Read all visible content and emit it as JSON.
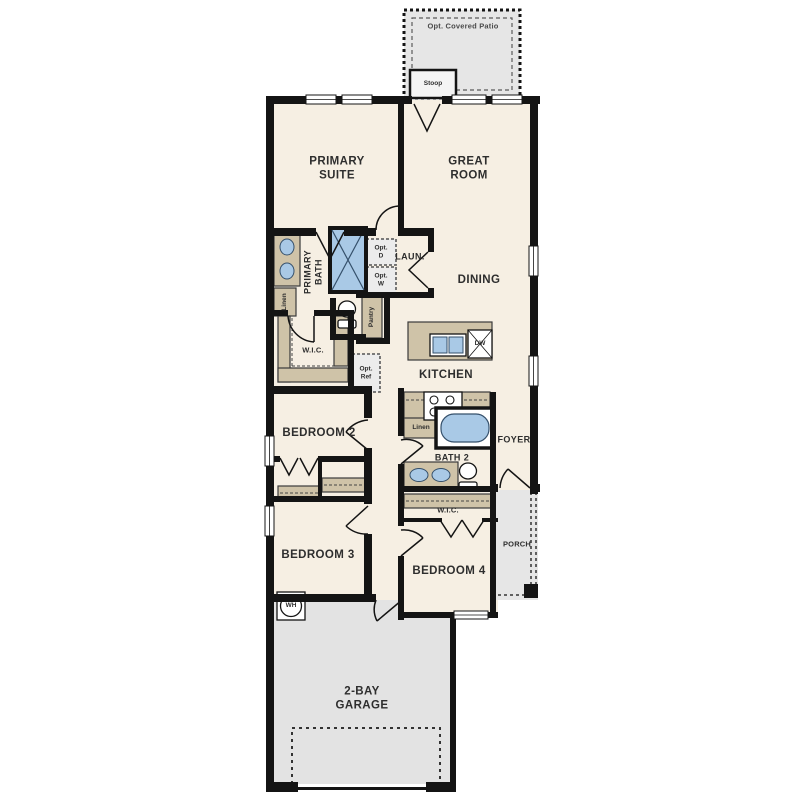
{
  "title": "Single-story floor plan",
  "colors": {
    "floor": "#f6efe3",
    "wall": "#141414",
    "concrete_gray": "#e3e3e3",
    "fixture_tan": "#cfc3a8",
    "fixture_blue": "#a9c9e6"
  },
  "labels": {
    "patio": "Opt. Covered Patio",
    "stoop": "Stoop",
    "primary_suite": "PRIMARY\nSUITE",
    "great_room": "GREAT\nROOM",
    "primary_bath": "PRIMARY\nBATH",
    "laundry": "LAUN.",
    "opt_dryer": "Opt.\nD",
    "opt_washer": "Opt.\nW",
    "linen_primary": "Linen",
    "pantry": "Pantry",
    "dining": "DINING",
    "wic_primary": "W.I.C.",
    "opt_ref": "Opt.\nRef",
    "dishwasher": "DW",
    "kitchen": "KITCHEN",
    "bedroom2": "BEDROOM 2",
    "linen_bath2": "Linen",
    "bath2": "BATH 2",
    "foyer": "FOYER",
    "bedroom3": "BEDROOM 3",
    "wic_bedroom4": "W.I.C.",
    "bedroom4": "BEDROOM 4",
    "porch": "PORCH",
    "water_heater": "WH",
    "garage": "2-BAY\nGARAGE"
  }
}
